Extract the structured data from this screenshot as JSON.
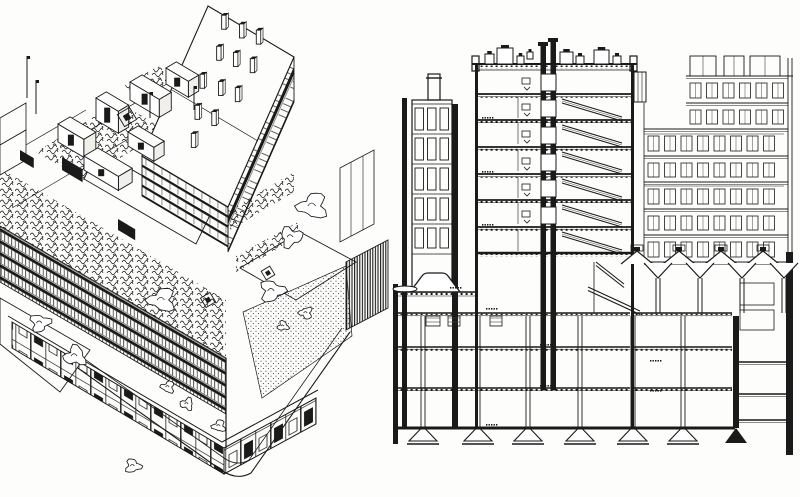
{
  "page": {
    "width": 800,
    "height": 497,
    "paper_color": "#fdfdfb",
    "ink_color": "#1a1a1a",
    "kind": "scanned black-ink architectural drawing"
  },
  "panels": {
    "axonometric": {
      "label": "axonometric view",
      "content": "bird's-eye axonometric of a terraced city block: tall rear wing with rooftop stacks, stepped roof gardens with dense planting, banded window facades, shopfront podium with rounded street corner, plaza with trees"
    },
    "section": {
      "label": "cross section",
      "content": "transverse section: multi-storey slab with central lift shaft and stairs over a three-level podium on mushroom columns with conical footings, flanked by neighbouring street facades"
    }
  },
  "axo": {
    "roof_quad": {
      "ax": 208,
      "ay": 6,
      "bx": 86,
      "by": 51,
      "dx": -66,
      "dy": 150
    },
    "roof_stacks": [
      [
        0.22,
        0.08
      ],
      [
        0.42,
        0.07
      ],
      [
        0.6,
        0.05
      ],
      [
        0.3,
        0.26
      ],
      [
        0.48,
        0.24
      ],
      [
        0.66,
        0.22
      ],
      [
        0.26,
        0.46
      ],
      [
        0.46,
        0.44
      ],
      [
        0.64,
        0.42
      ],
      [
        0.34,
        0.64
      ],
      [
        0.52,
        0.62
      ],
      [
        0.42,
        0.8
      ]
    ],
    "poles": [
      {
        "x": 27,
        "y": 98,
        "h": 42
      },
      {
        "x": 36,
        "y": 114,
        "h": 34
      },
      {
        "x": 150,
        "y": 118,
        "h": 26
      },
      {
        "x": 194,
        "y": 110,
        "h": 24
      }
    ],
    "penthouses": [
      {
        "x": 58,
        "y": 142,
        "w": 30,
        "d": 14,
        "h": 18
      },
      {
        "x": 96,
        "y": 120,
        "w": 26,
        "d": 12,
        "h": 22
      },
      {
        "x": 130,
        "y": 100,
        "w": 34,
        "d": 14,
        "h": 18
      },
      {
        "x": 166,
        "y": 84,
        "w": 26,
        "d": 12,
        "h": 16
      },
      {
        "x": 84,
        "y": 170,
        "w": 40,
        "d": 16,
        "h": 14
      },
      {
        "x": 128,
        "y": 146,
        "w": 30,
        "d": 12,
        "h": 14
      }
    ],
    "trees": [
      {
        "x": 313,
        "y": 206,
        "r": 13
      },
      {
        "x": 291,
        "y": 237,
        "r": 10
      },
      {
        "x": 272,
        "y": 291,
        "r": 11
      },
      {
        "x": 162,
        "y": 300,
        "r": 12
      },
      {
        "x": 75,
        "y": 356,
        "r": 10
      },
      {
        "x": 40,
        "y": 323,
        "r": 9
      },
      {
        "x": 168,
        "y": 387,
        "r": 6
      },
      {
        "x": 187,
        "y": 404,
        "r": 6
      },
      {
        "x": 219,
        "y": 426,
        "r": 6
      },
      {
        "x": 133,
        "y": 466,
        "r": 7
      },
      {
        "x": 306,
        "y": 313,
        "r": 6
      },
      {
        "x": 283,
        "y": 326,
        "r": 5
      }
    ],
    "skylights": [
      {
        "x": 127,
        "y": 117,
        "s": 14
      },
      {
        "x": 208,
        "y": 300,
        "s": 11
      },
      {
        "x": 268,
        "y": 273,
        "s": 10
      }
    ],
    "dark_openings": [
      {
        "x": 62,
        "y": 170,
        "w": 24,
        "h": 13
      },
      {
        "x": 118,
        "y": 230,
        "w": 20,
        "h": 11
      },
      {
        "x": 20,
        "y": 160,
        "w": 16,
        "h": 10
      }
    ]
  },
  "section": {
    "walls": [
      {
        "x": 3,
        "y": 284,
        "w": 5,
        "h": 160
      },
      {
        "x": 12,
        "y": 98,
        "w": 5,
        "h": 330
      },
      {
        "x": 62,
        "y": 104,
        "w": 6,
        "h": 324
      },
      {
        "x": 85,
        "y": 64,
        "w": 3,
        "h": 364
      },
      {
        "x": 241,
        "y": 64,
        "w": 3,
        "h": 364
      },
      {
        "x": 150.5,
        "y": 42,
        "w": 5.5,
        "h": 348
      },
      {
        "x": 160.5,
        "y": 38,
        "w": 5.5,
        "h": 352
      },
      {
        "x": 148,
        "y": 42,
        "w": 10,
        "h": 4
      },
      {
        "x": 158,
        "y": 38,
        "w": 10,
        "h": 4
      },
      {
        "x": 343,
        "y": 316,
        "w": 6,
        "h": 112
      },
      {
        "x": 396,
        "y": 252,
        "w": 7,
        "h": 203
      }
    ],
    "left_building": {
      "x": 22,
      "w": 40,
      "top": 100,
      "bottom": 292,
      "chimney": {
        "x": 38,
        "y": 74,
        "w": 12,
        "h": 26
      },
      "floor_lines": [
        134,
        164,
        194,
        224,
        254
      ],
      "window_rows": [
        {
          "y": 108,
          "h": 22
        },
        {
          "y": 138,
          "h": 22
        },
        {
          "y": 168,
          "h": 22
        },
        {
          "y": 198,
          "h": 22
        },
        {
          "y": 228,
          "h": 20
        }
      ],
      "cols": {
        "x0": 25,
        "step": 12.5,
        "n": 3,
        "w": 8.5
      }
    },
    "main_block": {
      "x1": 85,
      "x2": 244,
      "roof_y": 64,
      "floors": [
        94,
        120,
        147,
        174,
        200,
        227
      ],
      "podium_floor": 253,
      "rooftop_boxes": [
        {
          "x": 95,
          "y": 54,
          "w": 9,
          "h": 10
        },
        {
          "x": 107,
          "y": 48,
          "w": 16,
          "h": 16
        },
        {
          "x": 127,
          "y": 56,
          "w": 7,
          "h": 8
        },
        {
          "x": 137,
          "y": 52,
          "w": 6,
          "h": 7
        },
        {
          "x": 170,
          "y": 52,
          "w": 13,
          "h": 12
        },
        {
          "x": 186,
          "y": 56,
          "w": 8,
          "h": 8
        },
        {
          "x": 204,
          "y": 50,
          "w": 15,
          "h": 14
        },
        {
          "x": 223,
          "y": 56,
          "w": 8,
          "h": 8
        }
      ],
      "parapets": [
        {
          "x": 82,
          "y": 56
        },
        {
          "x": 240,
          "y": 56
        }
      ],
      "lift_x": 151,
      "stair_bay": [
        172,
        232
      ],
      "door_mark_x": 132,
      "partition_x": 128,
      "setback": {
        "x": 244,
        "y": 72,
        "w": 12,
        "h": 30
      }
    },
    "right_facade": {
      "x_full": 254,
      "x_upper": 296,
      "x_right": 394,
      "edge_x": [
        398,
        402
      ],
      "penthouse_boxes": [
        {
          "x": 300,
          "w": 26
        },
        {
          "x": 334,
          "w": 20
        },
        {
          "x": 360,
          "w": 30
        }
      ],
      "boundaries": [
        76,
        103,
        129,
        156,
        182,
        209,
        235,
        262
      ],
      "win_step": 16.5,
      "win_w": 11,
      "hatch_rows": [
        2,
        4
      ]
    },
    "podium": {
      "lantern": "M20 292 L32 276 Q34 273 38 273 L52 273 Q56 273 58 276 L70 292",
      "disc": {
        "cx": 15,
        "cy": 289,
        "rx": 12,
        "ry": 3
      },
      "left_slab_y": 292,
      "floors": [
        313,
        347,
        388
      ],
      "floor_segments": [
        [
          8,
          85
        ],
        [
          88,
          240
        ],
        [
          244,
          342
        ]
      ],
      "ground_y": 428,
      "ground_x1": 3,
      "ground_x2": 345,
      "columns": [
        33,
        88,
        138,
        190,
        243,
        293
      ],
      "funnels": [
        268,
        310,
        352,
        394
      ],
      "peaks": [
        247,
        289,
        331,
        373
      ],
      "eave_y": 263,
      "mezz_stairs": [
        [
          198,
          287,
          250,
          311
        ],
        [
          206,
          262,
          234,
          284
        ]
      ],
      "shaft_zone": {
        "x1": 349,
        "x2": 396,
        "floors": [
          362,
          394,
          420
        ],
        "rooms": [
          {
            "x": 350,
            "y": 283,
            "w": 34,
            "h": 22
          },
          {
            "x": 350,
            "y": 310,
            "w": 34,
            "h": 20
          }
        ],
        "triangle": [
          [
            346,
            428
          ],
          [
            335,
            443
          ],
          [
            357,
            443
          ]
        ]
      }
    },
    "storage_boxes": [
      {
        "x": 36,
        "y": 316,
        "w": 14,
        "h": 10
      },
      {
        "x": 58,
        "y": 316,
        "w": 12,
        "h": 10
      },
      {
        "x": 100,
        "y": 316,
        "w": 12,
        "h": 10
      }
    ],
    "level_marks": [
      {
        "x": 92,
        "y": 117
      },
      {
        "x": 92,
        "y": 171
      },
      {
        "x": 92,
        "y": 224
      },
      {
        "x": 60,
        "y": 287
      },
      {
        "x": 96,
        "y": 308
      },
      {
        "x": 150,
        "y": 344
      },
      {
        "x": 150,
        "y": 385
      },
      {
        "x": 260,
        "y": 360
      },
      {
        "x": 260,
        "y": 390
      },
      {
        "x": 96,
        "y": 424
      }
    ]
  }
}
